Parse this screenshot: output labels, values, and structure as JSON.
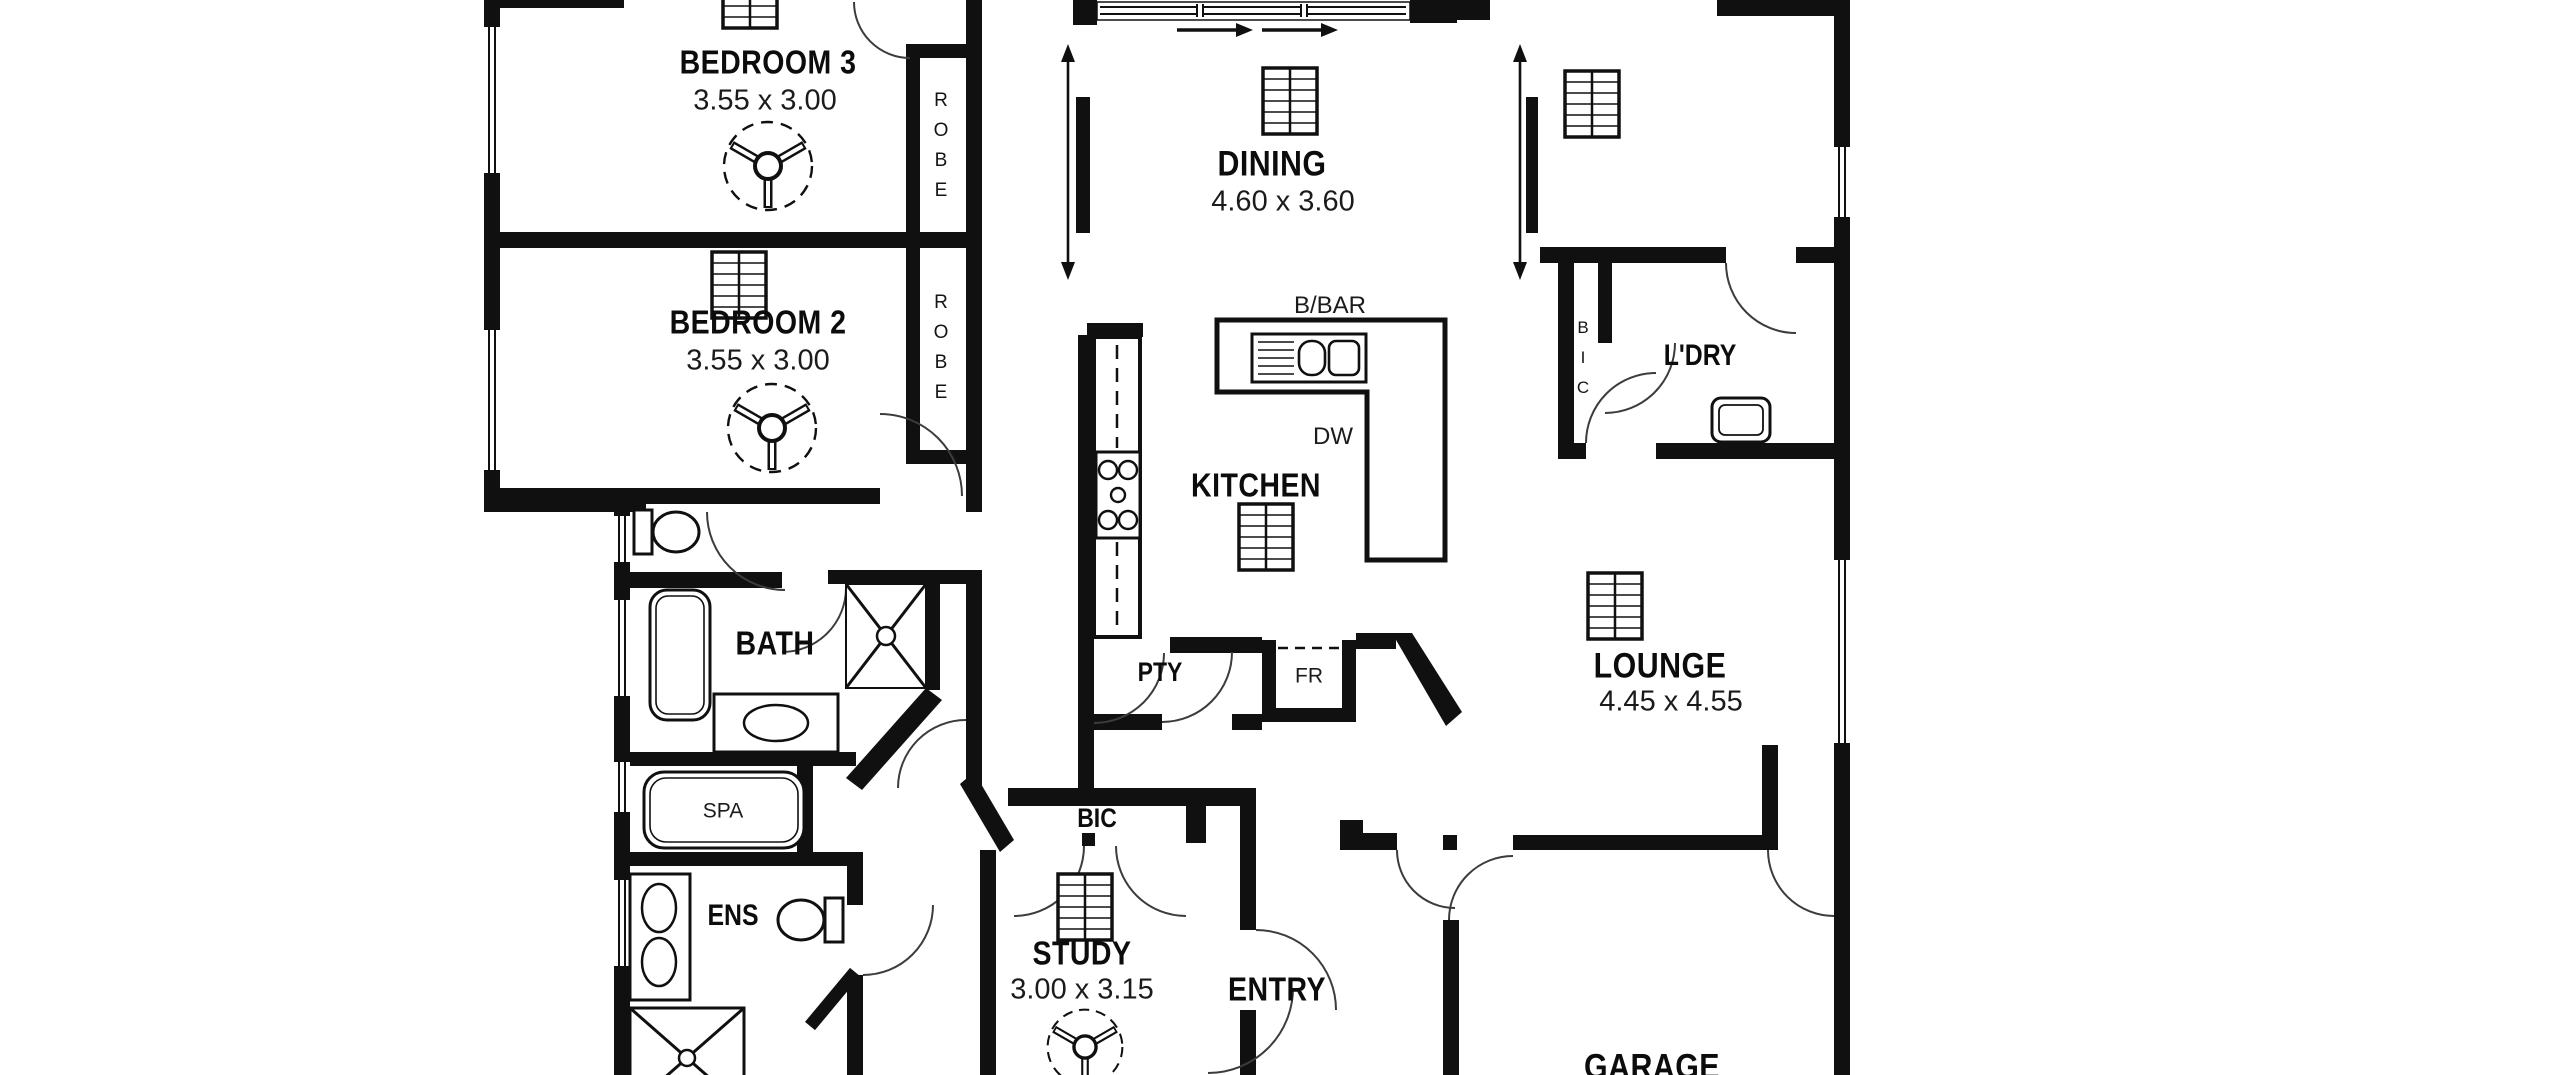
{
  "rooms": {
    "bedroom3": {
      "name": "BEDROOM 3",
      "dims": "3.55 x 3.00"
    },
    "bedroom2": {
      "name": "BEDROOM 2",
      "dims": "3.55 x 3.00"
    },
    "dining": {
      "name": "DINING",
      "dims": "4.60 x 3.60"
    },
    "kitchen": {
      "name": "KITCHEN"
    },
    "laundry": {
      "name": "L'DRY"
    },
    "lounge": {
      "name": "LOUNGE",
      "dims": "4.45 x 4.55"
    },
    "bath": {
      "name": "BATH"
    },
    "spa": {
      "name": "SPA"
    },
    "ensuite": {
      "name": "ENS"
    },
    "study": {
      "name": "STUDY",
      "dims": "3.00 x 3.15"
    },
    "entry": {
      "name": "ENTRY"
    },
    "garage": {
      "name": "GARAGE"
    },
    "pantry": {
      "name": "PTY"
    },
    "fridge": {
      "name": "FR"
    },
    "dishwasher": {
      "name": "DW"
    },
    "breakfast_bar": {
      "name": "B/BAR"
    },
    "robe_bed3": {
      "name": "ROBE"
    },
    "robe_bed2": {
      "name": "ROBE"
    },
    "bic_study": {
      "name": "BIC"
    },
    "bic_laundry": {
      "name": "BIC"
    }
  },
  "colors": {
    "wall": "#101010",
    "background": "#ffffff",
    "arc": "#3c3c3c"
  }
}
